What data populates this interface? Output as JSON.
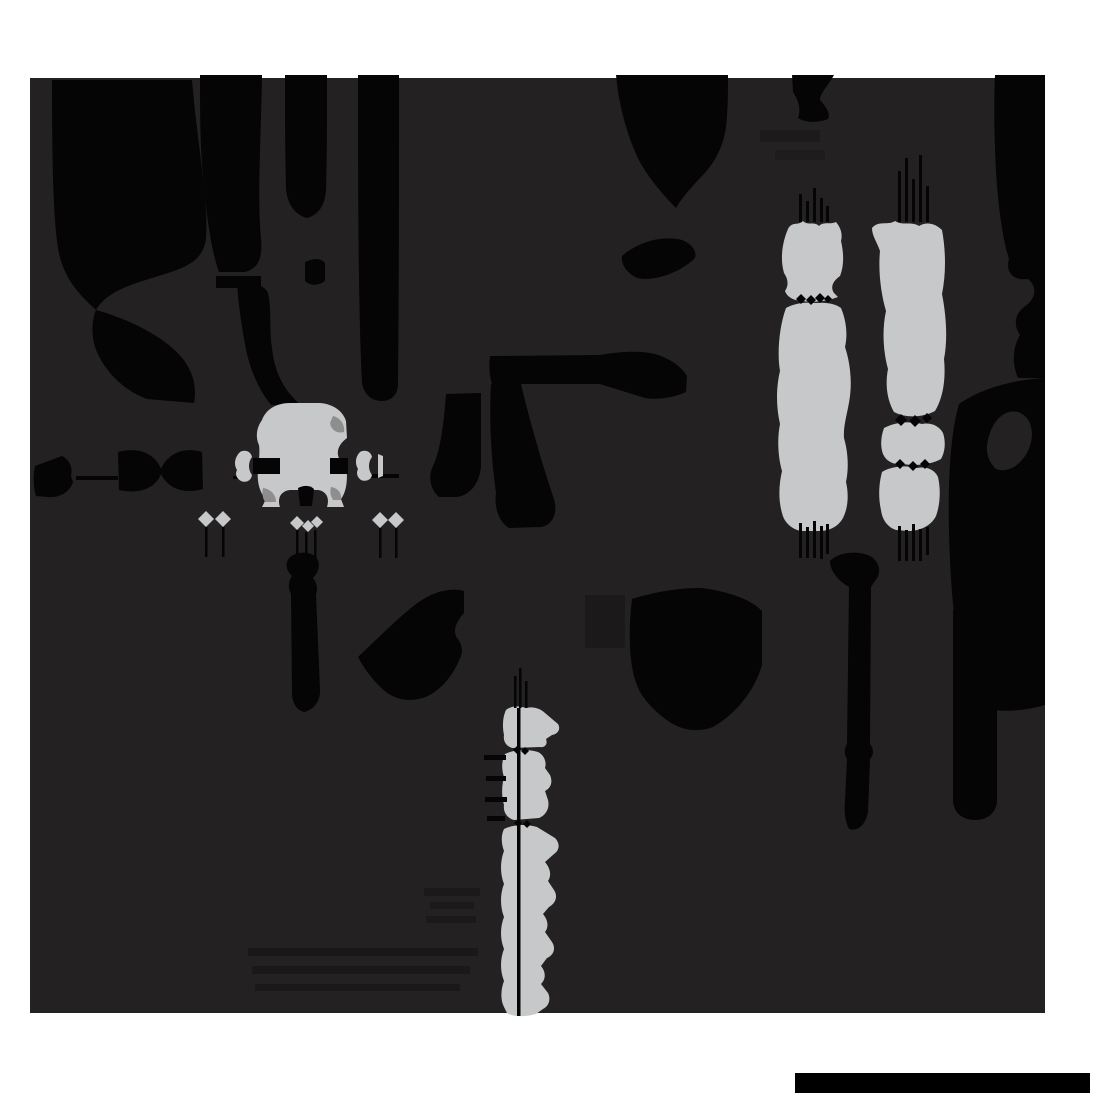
{
  "canvas": {
    "width": 1100,
    "height": 1100,
    "background": "#ffffff"
  },
  "palette": {
    "black": "#050505",
    "panel": "#242122",
    "gray": "#c7c8c9",
    "gray_dark": "#8e8e8f",
    "bar_black": "#000000",
    "white": "#ffffff"
  },
  "panel": {
    "x": 30,
    "y": 78,
    "width": 1015,
    "height": 935
  },
  "bottom_bar": {
    "x": 795,
    "y": 1073,
    "width": 295,
    "height": 20
  },
  "shapes": [
    {
      "name": "panel-background",
      "fill": "panel",
      "d": "M30,78 H1045 V1013 H30 Z"
    },
    {
      "name": "faint-rect",
      "fill": "black",
      "opacity": 0.3,
      "d": "M585,595 h40 v53 h-40 Z"
    },
    {
      "name": "faint-streak",
      "fill": "black",
      "opacity": 0.25,
      "d": "M424,888 h56 v8 h-56 Z"
    },
    {
      "name": "faint-streak",
      "fill": "black",
      "opacity": 0.25,
      "d": "M430,902 h44 v7 h-44 Z"
    },
    {
      "name": "faint-streak",
      "fill": "black",
      "opacity": 0.25,
      "d": "M426,916 h50 v7 h-50 Z"
    },
    {
      "name": "faint-band",
      "fill": "black",
      "opacity": 0.28,
      "d": "M248,948 h230 v8 h-230 Z"
    },
    {
      "name": "faint-band",
      "fill": "black",
      "opacity": 0.28,
      "d": "M252,966 h218 v8 h-218 Z"
    },
    {
      "name": "faint-band",
      "fill": "black",
      "opacity": 0.28,
      "d": "M255,984 h205 v7 h-205 Z"
    },
    {
      "name": "faint-blob",
      "fill": "black",
      "opacity": 0.22,
      "d": "M760,130 h60 v12 h-60 Z"
    },
    {
      "name": "faint-blob",
      "fill": "black",
      "opacity": 0.18,
      "d": "M775,150 h50 v10 h-50 Z"
    },
    {
      "name": "top-left-mass-upper",
      "fill": "black",
      "d": "M52,80 L192,80 C197,142 209,202 206,238 C204,258 190,266 168,273 C140,282 108,289 96,310 C84,299 68,284 61,261 C53,236 52,160 52,80 Z"
    },
    {
      "name": "top-left-mass-tail",
      "fill": "black",
      "d": "M96,310 C132,320 166,338 183,359 C193,372 197,388 194,403 L147,399 C120,389 102,367 95,347 C91,333 92,320 96,310 Z"
    },
    {
      "name": "top-left-column-2",
      "fill": "black",
      "d": "M200,75 L262,75 C261,138 257,198 261,238 C263,260 257,269 245,272 L219,272 C210,248 204,198 201,148 C200,122 200,98 200,75 Z"
    },
    {
      "name": "top-left-column-2-fragment",
      "fill": "black",
      "d": "M216,276 h45 v12 h-45 Z"
    },
    {
      "name": "top-left-column-2-lower-strip",
      "fill": "black",
      "d": "M237,280 C254,282 265,286 268,293 C272,310 269,330 272,348 C274,367 280,382 290,394 L299,404 L271,405 C259,390 250,370 246,349 C242,329 238,304 237,280 Z"
    },
    {
      "name": "top-left-column-3",
      "fill": "black",
      "d": "M285,75 L327,75 C327,118 327,160 326,190 C325,206 318,215 307,218 C295,215 287,204 286,188 C285,150 285,110 285,75 Z"
    },
    {
      "name": "top-left-column-3-bridge",
      "fill": "black",
      "d": "M305,262 C314,258 321,258 325,263 L325,281 C318,286 310,286 305,281 Z"
    },
    {
      "name": "top-left-column-4",
      "fill": "black",
      "d": "M358,75 L399,75 C399,180 399,290 398,384 C398,395 391,401 382,401 C371,401 364,394 362,383 C358,300 358,180 358,75 Z"
    },
    {
      "name": "bell-blob",
      "fill": "black",
      "d": "M616,75 L728,75 C728,90 728,103 727,115 C726,147 713,165 700,178 C689,190 681,199 676,208 C664,196 651,181 641,164 C629,142 619,108 616,75 Z"
    },
    {
      "name": "eye-blob",
      "fill": "black",
      "d": "M622,256 C638,242 662,235 682,240 C692,244 697,251 695,258 C681,272 655,282 637,278 C627,273 621,265 622,256 Z"
    },
    {
      "name": "top-x-blob",
      "fill": "black",
      "d": "M792,75 L834,75 C828,86 820,93 820,100 C826,107 831,114 828,119 C818,123 806,123 798,118 C801,110 799,101 793,92 Z"
    },
    {
      "name": "right-edge-ribbon-top",
      "fill": "black",
      "d": "M995,75 L1045,75 L1045,335 L1020,335 C1013,325 1015,314 1024,307 C1036,299 1038,287 1028,279 C1014,281 1005,273 1009,259 C1001,234 996,188 995,148 C994,120 994,95 995,75 Z"
    },
    {
      "name": "right-edge-ribbon-mid",
      "fill": "black",
      "d": "M1020,335 L1045,335 L1045,378 L1018,378 C1012,364 1012,349 1020,335 Z"
    },
    {
      "name": "right-edge-mass",
      "fill": "black",
      "d": "M1045,378 L1045,705 C1022,712 998,712 980,708 C963,680 953,630 950,560 C947,498 949,438 959,404 C979,390 1009,380 1045,378 Z"
    },
    {
      "name": "right-edge-mass-bite",
      "fill": "panel",
      "d": "M988,440 C992,421 1004,409 1018,412 C1030,416 1035,430 1030,446 C1024,463 1009,474 996,469 C988,461 985,452 988,440 Z"
    },
    {
      "name": "right-vertical-bar",
      "fill": "black",
      "d": "M953,610 L997,610 L997,800 C997,812 988,820 975,820 C962,820 953,812 953,800 Z"
    },
    {
      "name": "right-thin-bar",
      "fill": "black",
      "d": "M830,561 C838,552 858,550 870,556 C880,562 882,573 875,581 L871,587 L870,744 C874,749 874,755 870,759 L868,812 C866,824 858,832 849,829 C845,821 844,811 845,801 L847,759 C844,754 844,749 847,744 L849,587 C840,582 830,572 830,561 Z"
    },
    {
      "name": "bottle-blob",
      "fill": "black",
      "d": "M289,558 C296,551 310,551 316,557 C321,563 319,572 313,578 C317,583 318,589 316,594 L320,689 C321,700 314,710 304,712 C296,710 292,702 292,693 L291,594 C288,588 288,581 292,576 C286,570 285,564 289,558 Z"
    },
    {
      "name": "flag-blob",
      "fill": "black",
      "d": "M358,657 C378,638 398,618 416,604 C432,592 450,587 464,591 L464,613 C457,621 452,630 457,638 C462,644 463,650 461,656 C454,674 443,688 428,696 C412,703 396,700 386,692 C374,682 365,670 358,657 Z"
    },
    {
      "name": "shark-fin-blob",
      "fill": "black",
      "d": "M632,599 C658,591 680,588 701,588 C728,591 752,600 762,611 L762,665 C755,690 736,714 713,727 C697,733 681,730 668,721 C653,710 641,697 637,685 C629,666 628,632 632,599 Z"
    },
    {
      "name": "seven-top-bar",
      "fill": "black",
      "d": "M490,356 L600,355 C622,351 646,350 661,356 C674,361 683,369 687,376 L686,392 C672,398 658,400 645,398 L600,384 L492,384 C489,375 489,365 490,356 Z"
    },
    {
      "name": "seven-leg",
      "fill": "black",
      "d": "M491,384 L521,384 C529,418 542,464 554,499 C558,513 553,525 541,527 L509,528 C499,522 494,508 496,493 C491,457 489,419 491,384 Z"
    },
    {
      "name": "small-bar-blob",
      "fill": "black",
      "d": "M446,394 L481,393 L481,467 C479,484 470,495 457,497 L439,497 C430,489 428,476 433,466 C440,452 444,423 446,394 Z"
    },
    {
      "name": "bowtie-left-half",
      "fill": "black",
      "d": "M35,466 L62,456 C70,460 73,468 71,476 L73,482 C70,492 60,498 48,497 L36,496 C33,486 33,475 35,466 Z"
    },
    {
      "name": "bowtie-arrow",
      "fill": "black",
      "d": "M118,452 C140,446 156,455 161,469 C167,455 182,446 202,452 L203,489 C182,495 167,487 161,474 C156,487 141,495 119,490 Z"
    },
    {
      "name": "hairline",
      "fill": "black",
      "d": "M76,476 h42 v4 h-42 Z"
    },
    {
      "name": "hairline",
      "fill": "black",
      "d": "M371,474 h28 v4 h-28 Z"
    },
    {
      "name": "hairline",
      "fill": "black",
      "d": "M233,476 h10 v3 h-10 Z"
    },
    {
      "name": "part-body",
      "fill": "gray",
      "d": "M262,420 C266,409 277,403 290,403 L320,403 C333,404 343,411 346,421 L347,438 C339,444 336,451 339,458 L346,464 C348,478 347,491 341,499 L344,507 L327,507 C330,498 326,491 318,490 L290,490 C281,491 277,498 280,507 L262,507 L266,499 C259,492 257,481 258,470 C259,459 260,452 259,445 C255,436 257,427 262,420 Z"
    },
    {
      "name": "part-shade",
      "fill": "gray_dark",
      "d": "M333,416 C341,418 345,425 344,432 C337,434 331,430 330,423 Z"
    },
    {
      "name": "part-shade",
      "fill": "gray_dark",
      "d": "M263,488 C271,489 276,495 276,502 L265,502 C262,497 262,492 263,488 Z"
    },
    {
      "name": "part-shade",
      "fill": "gray_dark",
      "d": "M331,487 C338,488 342,493 341,500 L333,500 C330,495 330,491 331,487 Z"
    },
    {
      "name": "dimension-bone-left",
      "fill": "gray",
      "d": "M240,452 C246,449 251,452 252,457 C248,462 248,470 252,475 C251,481 246,483 241,481 C236,478 235,474 237,470 C234,465 234,458 240,452 Z"
    },
    {
      "name": "dimension-bone-right",
      "fill": "gray",
      "d": "M360,452 C366,449 371,452 372,457 C368,462 368,470 372,475 C371,480 366,482 361,480 C357,477 356,473 358,469 C355,464 355,457 360,452 Z"
    },
    {
      "name": "gray-sliver",
      "fill": "gray",
      "d": "M378,454 L383,456 L383,476 L378,478 Z"
    },
    {
      "name": "pin-diamond",
      "fill": "gray",
      "d": "M206,511 L214,519 L206,527 L198,519 Z"
    },
    {
      "name": "pin-diamond",
      "fill": "gray",
      "d": "M223,511 L231,519 L223,527 L215,519 Z"
    },
    {
      "name": "pin-diamond",
      "fill": "gray",
      "d": "M297,516 L304,523 L297,530 L290,523 Z"
    },
    {
      "name": "pin-diamond",
      "fill": "gray",
      "d": "M308,520 L314,526 L308,532 L302,526 Z"
    },
    {
      "name": "pin-diamond",
      "fill": "gray",
      "d": "M317,516 L323,522 L317,528 L311,522 Z"
    },
    {
      "name": "pin-diamond",
      "fill": "gray",
      "d": "M380,512 L388,520 L380,528 L372,520 Z"
    },
    {
      "name": "pin-diamond",
      "fill": "gray",
      "d": "M396,512 L404,520 L396,528 L388,520 Z"
    },
    {
      "name": "gray-column-1-upper",
      "fill": "gray",
      "d": "M788,229 C792,221 798,226 803,221 C808,226 814,221 819,226 C824,221 830,225 836,222 C840,227 843,233 841,241 C844,254 844,266 840,276 C833,281 830,287 834,293 L838,297 C828,301 813,303 803,301 C794,301 787,297 785,291 C789,285 788,279 784,273 C780,259 782,243 788,229 Z"
    },
    {
      "name": "gray-column-1-lower",
      "fill": "gray",
      "d": "M786,308 C795,303 806,302 816,303 C826,302 836,304 841,308 C846,320 848,334 845,347 C850,362 852,380 850,396 C848,412 843,425 844,438 C848,452 849,468 846,482 C849,495 848,508 843,518 C838,527 829,531 819,531 L801,531 C791,529 784,522 782,513 C778,499 779,484 782,471 C778,457 777,439 780,424 C776,407 776,387 780,371 C777,354 779,327 786,308 Z"
    },
    {
      "name": "gray-column-2-upper",
      "fill": "gray",
      "d": "M872,228 C879,220 887,226 895,221 C903,226 911,221 919,226 C927,221 936,224 942,230 C946,252 946,274 942,294 C946,314 948,339 944,359 C946,379 943,398 935,411 C922,418 905,418 894,412 C887,400 885,384 888,369 C883,351 882,329 886,311 C881,294 878,271 880,251 C877,242 872,236 872,228 Z"
    },
    {
      "name": "gray-column-2-mid",
      "fill": "gray",
      "d": "M884,428 C895,422 910,421 922,424 C932,422 940,427 943,433 C946,442 945,452 941,459 C930,465 915,466 903,464 C893,465 886,461 883,454 C880,446 881,436 884,428 Z"
    },
    {
      "name": "gray-column-2-lower",
      "fill": "gray",
      "d": "M882,472 C892,466 905,465 917,468 C927,466 935,470 938,477 C941,490 940,505 936,516 C931,526 920,531 908,531 L896,530 C887,527 882,519 881,510 C878,497 879,483 882,472 Z"
    },
    {
      "name": "bottom-column-seg-1",
      "fill": "gray",
      "d": "M506,710 C512,705 520,706 526,708 C534,706 541,709 545,713 L558,724 C561,729 558,734 552,735 L546,739 C548,744 545,748 540,747 L512,748 C506,746 503,741 504,735 C502,726 503,716 506,710 Z"
    },
    {
      "name": "bottom-column-seg-2",
      "fill": "gray",
      "d": "M505,754 C515,749 528,749 538,752 C544,755 547,762 545,768 L550,775 C553,782 551,788 545,791 L548,800 C550,808 546,815 539,818 L514,820 C507,818 503,812 504,805 C501,795 502,785 504,777 C501,768 502,760 505,754 Z"
    },
    {
      "name": "bottom-column-seg-3",
      "fill": "gray",
      "d": "M504,829 C514,824 527,824 537,827 L555,838 C560,843 560,850 554,854 L545,862 C550,868 552,875 548,881 L554,890 C558,896 556,903 549,907 L543,914 C548,920 549,927 545,932 L552,942 C556,948 554,955 547,958 L541,966 C546,972 546,979 541,984 L548,993 C551,999 549,1006 543,1009 L536,1014 C526,1017 513,1017 507,1013 L504,1007 C500,999 501,989 504,981 C500,971 500,959 504,949 C500,939 500,927 504,917 C500,907 500,894 504,884 C500,874 500,861 504,851 C501,843 501,835 504,829 Z"
    },
    {
      "name": "arrow-bar",
      "fill": "black",
      "d": "M253,458 h27 v16 h-27 Z"
    },
    {
      "name": "arrow-bar",
      "fill": "black",
      "d": "M330,458 h18 v16 h-18 Z"
    },
    {
      "name": "part-notch",
      "fill": "black",
      "d": "M298,488 C304,485 310,485 314,489 L312,506 L300,506 Z"
    },
    {
      "name": "pinch-diamond",
      "fill": "black",
      "d": "M801,294 L806,299 L801,304 L796,299 Z"
    },
    {
      "name": "pinch-diamond",
      "fill": "black",
      "d": "M811,295 L816,300 L811,305 L806,300 Z"
    },
    {
      "name": "pinch-diamond",
      "fill": "black",
      "d": "M820,293 L825,298 L820,303 L815,298 Z"
    },
    {
      "name": "pinch-diamond",
      "fill": "black",
      "d": "M828,295 L832,299 L828,303 L824,299 Z"
    },
    {
      "name": "pinch-diamond",
      "fill": "black",
      "d": "M901,414 L907,420 L901,426 L895,420 Z"
    },
    {
      "name": "pinch-diamond",
      "fill": "black",
      "d": "M915,415 L921,421 L915,427 L909,421 Z"
    },
    {
      "name": "pinch-diamond",
      "fill": "black",
      "d": "M927,413 L932,418 L927,423 L922,418 Z"
    },
    {
      "name": "pinch-diamond",
      "fill": "black",
      "d": "M900,459 L905,464 L900,469 L895,464 Z"
    },
    {
      "name": "pinch-diamond",
      "fill": "black",
      "d": "M913,461 L918,466 L913,471 L908,466 Z"
    },
    {
      "name": "pinch-diamond",
      "fill": "black",
      "d": "M925,459 L930,464 L925,469 L920,464 Z"
    },
    {
      "name": "pinch-diamond",
      "fill": "black",
      "d": "M517,746 L521,750 L517,754 L513,750 Z"
    },
    {
      "name": "pinch-diamond",
      "fill": "black",
      "d": "M525,747 L529,751 L525,755 L521,751 Z"
    },
    {
      "name": "pinch-diamond",
      "fill": "black",
      "d": "M518,819 L522,823 L518,827 L514,823 Z"
    },
    {
      "name": "pinch-diamond",
      "fill": "black",
      "d": "M527,820 L531,824 L527,828 L523,824 Z"
    },
    {
      "name": "leader-line",
      "fill": "black",
      "d": "M799,194 h3 v28 h-3 Z"
    },
    {
      "name": "leader-line",
      "fill": "black",
      "d": "M806,201 h3 v21 h-3 Z"
    },
    {
      "name": "leader-line",
      "fill": "black",
      "d": "M813,188 h3 v34 h-3 Z"
    },
    {
      "name": "leader-line",
      "fill": "black",
      "d": "M820,198 h3 v24 h-3 Z"
    },
    {
      "name": "leader-line",
      "fill": "black",
      "d": "M826,206 h3 v16 h-3 Z"
    },
    {
      "name": "leader-line",
      "fill": "black",
      "d": "M898,171 h3 v51 h-3 Z"
    },
    {
      "name": "leader-line",
      "fill": "black",
      "d": "M905,158 h3 v64 h-3 Z"
    },
    {
      "name": "leader-line",
      "fill": "black",
      "d": "M912,179 h3 v43 h-3 Z"
    },
    {
      "name": "leader-line",
      "fill": "black",
      "d": "M919,155 h3 v67 h-3 Z"
    },
    {
      "name": "leader-line",
      "fill": "black",
      "d": "M926,186 h3 v36 h-3 Z"
    },
    {
      "name": "leader-line",
      "fill": "black",
      "d": "M799,523 h3 v35 h-3 Z"
    },
    {
      "name": "leader-line",
      "fill": "black",
      "d": "M806,527 h3 v31 h-3 Z"
    },
    {
      "name": "leader-line",
      "fill": "black",
      "d": "M813,521 h3 v37 h-3 Z"
    },
    {
      "name": "leader-line",
      "fill": "black",
      "d": "M820,526 h3 v33 h-3 Z"
    },
    {
      "name": "leader-line",
      "fill": "black",
      "d": "M826,524 h3 v30 h-3 Z"
    },
    {
      "name": "leader-line",
      "fill": "black",
      "d": "M898,526 h3 v35 h-3 Z"
    },
    {
      "name": "leader-line",
      "fill": "black",
      "d": "M905,530 h3 v31 h-3 Z"
    },
    {
      "name": "leader-line",
      "fill": "black",
      "d": "M912,524 h3 v37 h-3 Z"
    },
    {
      "name": "leader-line",
      "fill": "black",
      "d": "M919,529 h3 v32 h-3 Z"
    },
    {
      "name": "leader-line",
      "fill": "black",
      "d": "M926,527 h3 v28 h-3 Z"
    },
    {
      "name": "leader-line",
      "fill": "black",
      "d": "M514,676 h2.5 v32 h-2.5 Z"
    },
    {
      "name": "leader-line",
      "fill": "black",
      "d": "M519,668 h2.5 v40 h-2.5 Z"
    },
    {
      "name": "leader-line",
      "fill": "black",
      "d": "M525,681 h2.5 v27 h-2.5 Z"
    },
    {
      "name": "column-center-line",
      "fill": "black",
      "d": "M517,708 h3.5 v308 h-3.5 Z"
    },
    {
      "name": "pin-hairline",
      "fill": "black",
      "d": "M205,527 h2.5 v30 h-2.5 Z"
    },
    {
      "name": "pin-hairline",
      "fill": "black",
      "d": "M222,527 h2.5 v30 h-2.5 Z"
    },
    {
      "name": "pin-hairline",
      "fill": "black",
      "d": "M296,530 h2.5 v30 h-2.5 Z"
    },
    {
      "name": "pin-hairline",
      "fill": "black",
      "d": "M305,532 h2.5 v28 h-2.5 Z"
    },
    {
      "name": "pin-hairline",
      "fill": "black",
      "d": "M314,530 h2.5 v28 h-2.5 Z"
    },
    {
      "name": "pin-hairline",
      "fill": "black",
      "d": "M379,528 h2.5 v30 h-2.5 Z"
    },
    {
      "name": "pin-hairline",
      "fill": "black",
      "d": "M395,528 h2.5 v30 h-2.5 Z"
    },
    {
      "name": "tick-mark",
      "fill": "black",
      "d": "M484,755 h22 v5 h-22 Z"
    },
    {
      "name": "tick-mark",
      "fill": "black",
      "d": "M486,776 h20 v5 h-20 Z"
    },
    {
      "name": "tick-mark",
      "fill": "black",
      "d": "M485,797 h22 v5 h-22 Z"
    },
    {
      "name": "tick-mark",
      "fill": "black",
      "d": "M487,816 h18 v5 h-18 Z"
    },
    {
      "name": "bottom-scale-bar",
      "fill": "bar_black",
      "d": "M795,1073 h295 v20 h-295 Z"
    }
  ]
}
